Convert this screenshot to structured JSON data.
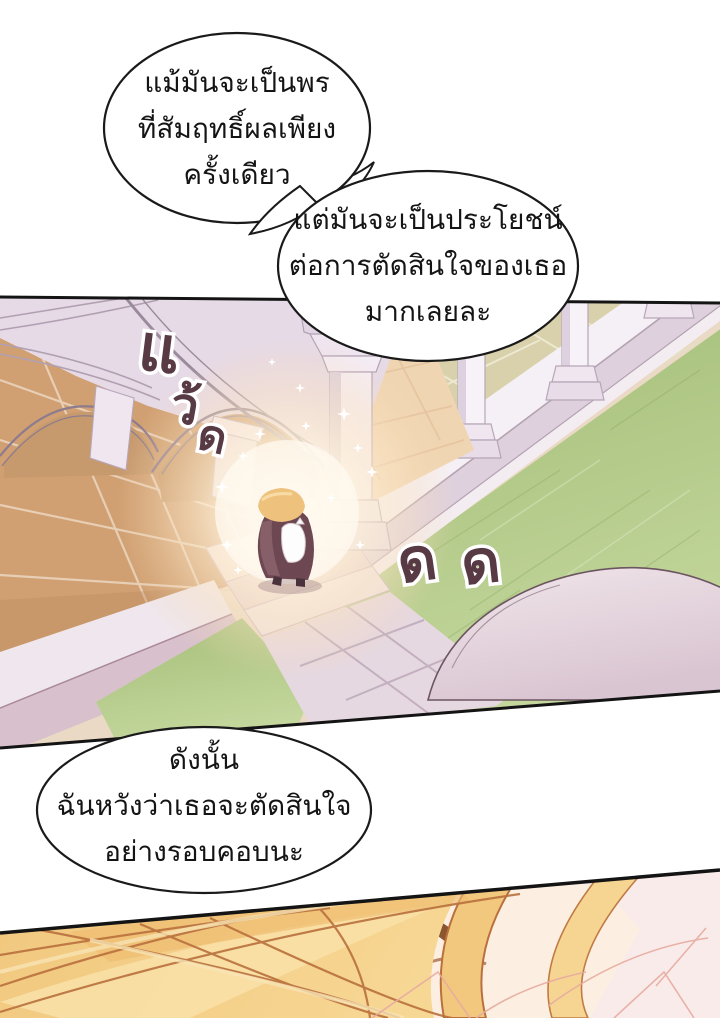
{
  "page": {
    "width": 720,
    "height": 1018,
    "background": "#ffffff",
    "media": "translated webtoon comic page",
    "language": "th"
  },
  "speech": {
    "bubble1": {
      "line1": "แม้มันจะเป็นพร",
      "line2": "ที่สัมฤทธิ์ผลเพียง",
      "line3": "ครั้งเดียว"
    },
    "bubble2": {
      "line1": "แต่มันจะเป็นประโยชน์",
      "line2": "ต่อการตัดสินใจของเธอ",
      "line3": "มากเลยละ"
    },
    "bubble3": {
      "line1": "ดังนั้น",
      "line2": "ฉันหวังว่าเธอจะตัดสินใจ",
      "line3": "อย่างรอบคอบนะ"
    }
  },
  "sfx": {
    "word": "แว้ด",
    "stack": [
      "แ",
      "ว้",
      "ด"
    ],
    "grass": [
      "ด",
      "ด"
    ],
    "fill": "#573a44",
    "outline": "#ffffff"
  },
  "art": {
    "panel1": "aerial view of a palace cloister: pale stone arches and columns, terracotta and beige tiled floors, green lawns, a small glowing blonde figure holding a white cat at the top of garden steps, white sparkles",
    "panel2": "extreme close-up of golden blonde hair sweeping diagonally across the frame with a brow and skin showing between strands"
  },
  "palette": {
    "outline": "#141414",
    "stone": "#e6dae7",
    "terracotta": "#d0a072",
    "beige_tiles": "#d8d1ab",
    "lawn": "#a9c37f",
    "walkway": "#e6d8e0",
    "dome": "#e7d6df",
    "glow": "#fff6e3",
    "hair_gold": "#f3cb82",
    "hair_line": "#b9703d",
    "cloak": "#6d4852",
    "sfx_maroon": "#573a44"
  }
}
